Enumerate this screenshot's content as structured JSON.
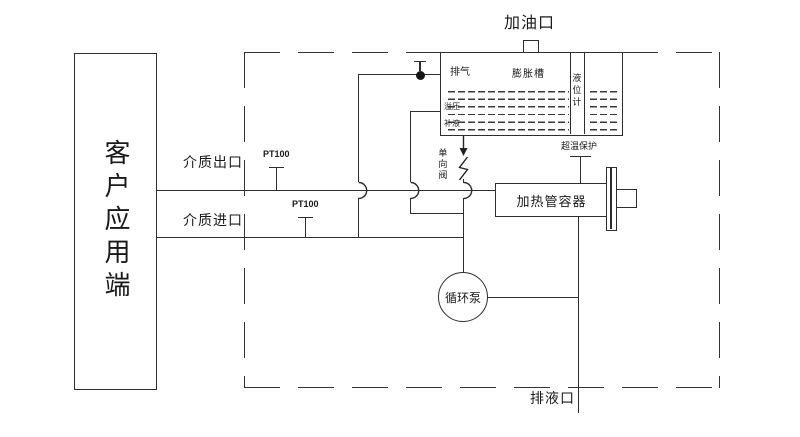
{
  "diagram": {
    "customer": {
      "label": "客户应用端"
    },
    "ports": {
      "fill": "加油口",
      "drain": "排液口",
      "medium_outlet": "介质出口",
      "medium_inlet": "介质进口"
    },
    "tank": {
      "vent": "排气",
      "name": "膨胀槽",
      "level_gauge": "液位计",
      "overflow": "溢压",
      "replenish": "补液"
    },
    "sensors": {
      "pt100_outlet": "PT100",
      "pt100_inlet": "PT100",
      "overtemp": "超温保护"
    },
    "components": {
      "check_valve": "单向阀",
      "heater_vessel": "加热管容器",
      "pump": "循环泵"
    },
    "colors": {
      "line": "#333333",
      "background": "#ffffff",
      "text": "#1a1a1a"
    }
  }
}
